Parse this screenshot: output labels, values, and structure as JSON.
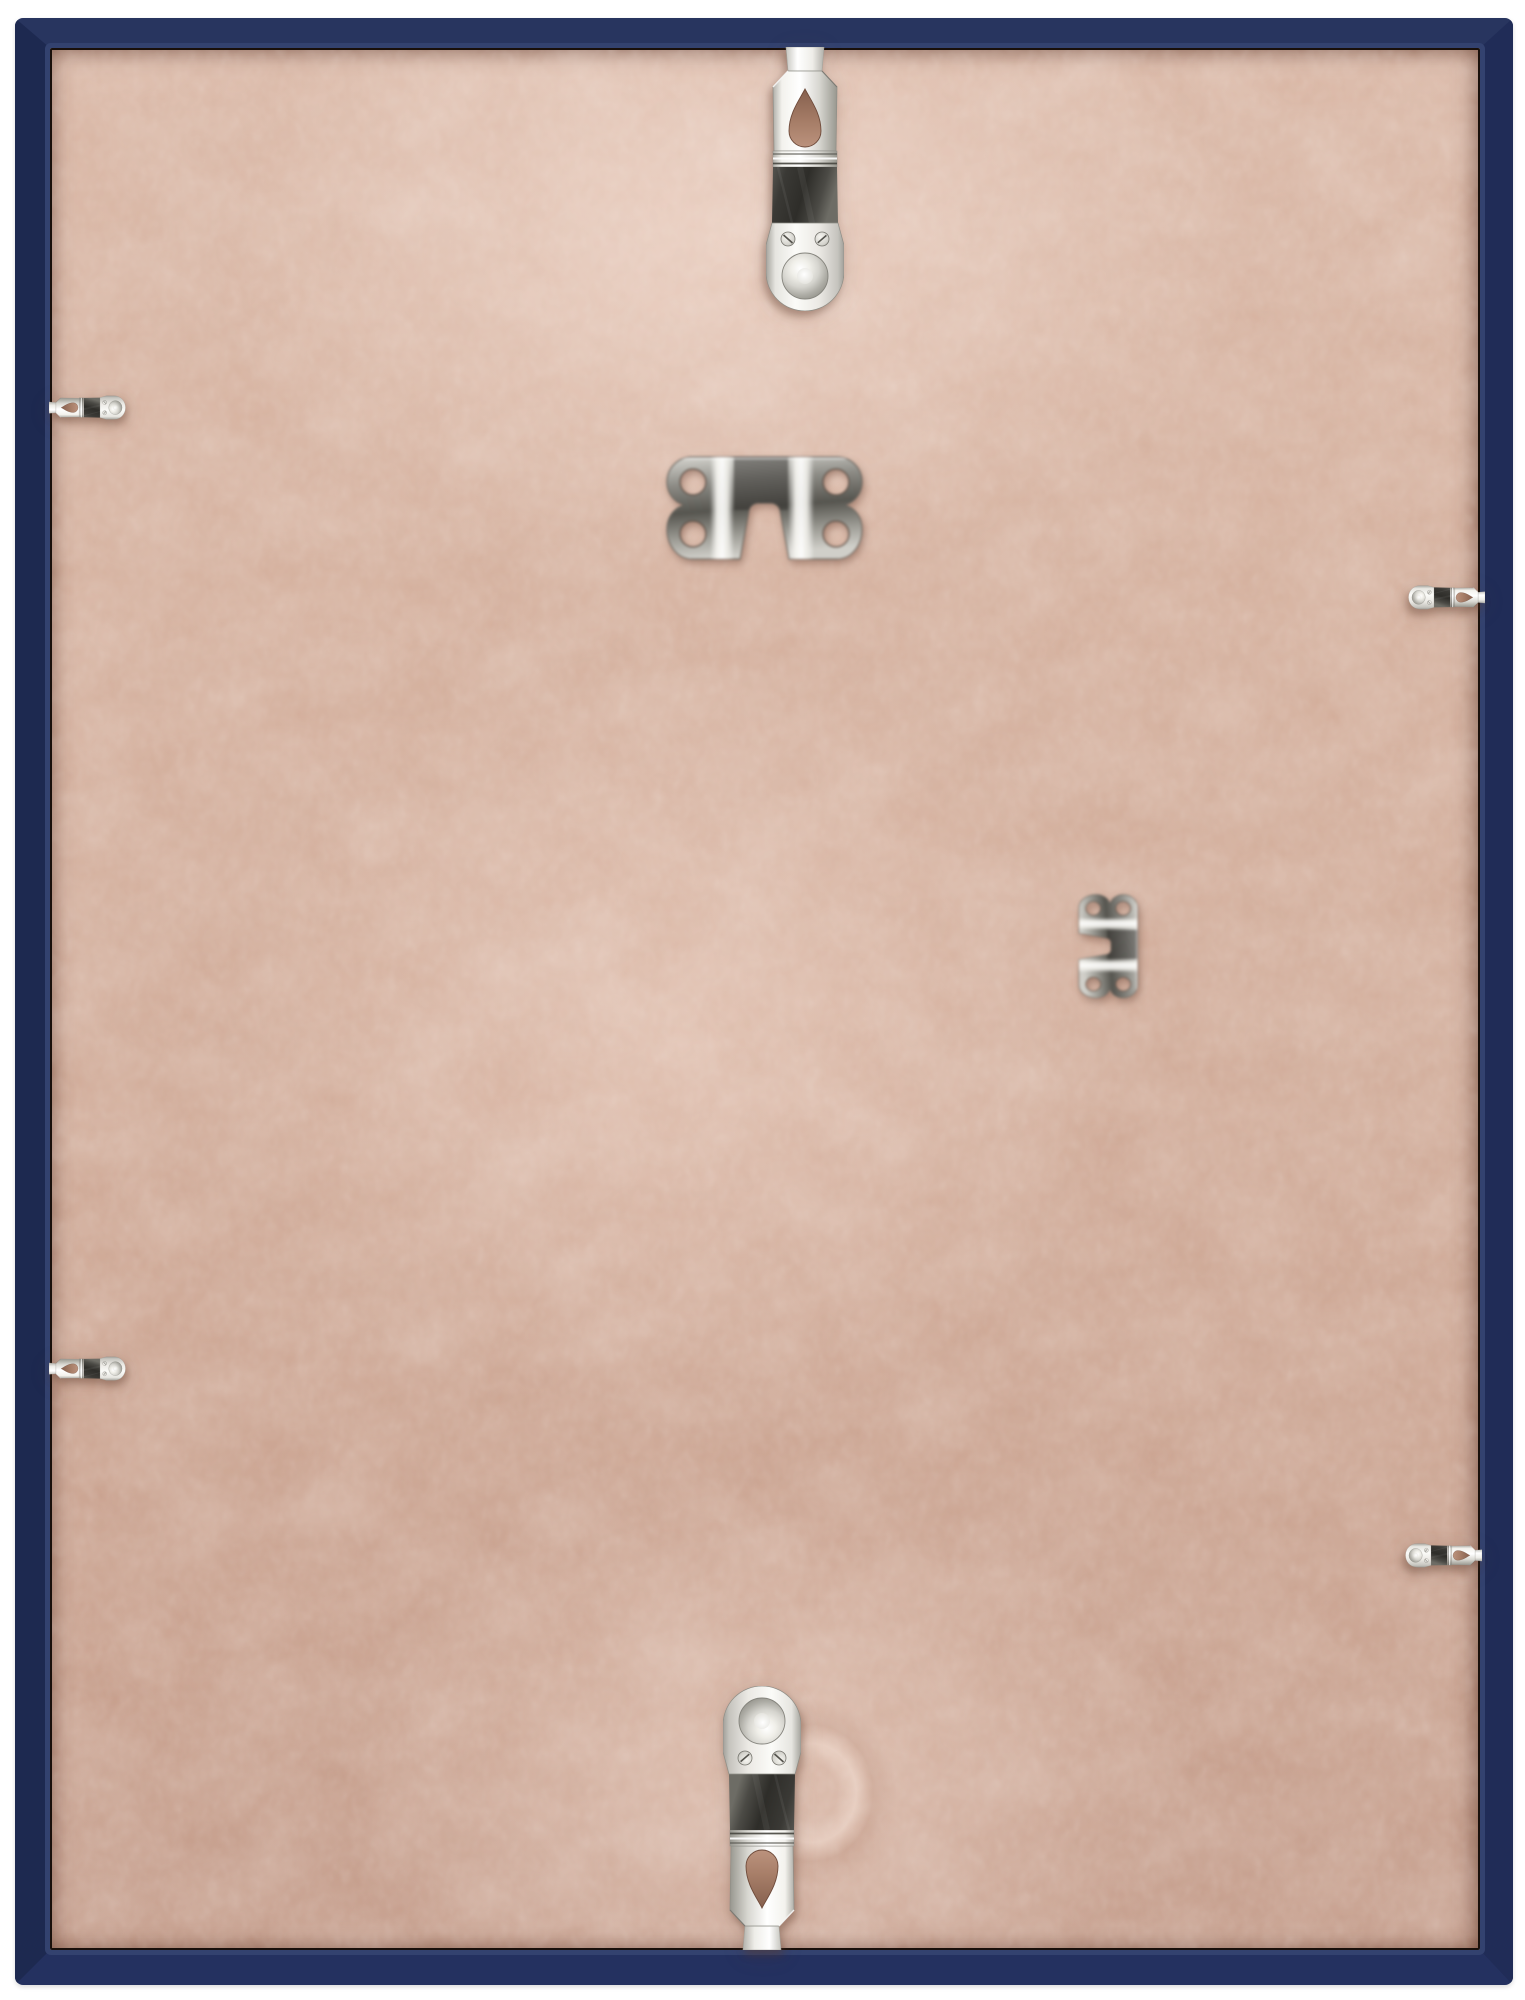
{
  "scene": {
    "subject": "Back view of a navy blue picture frame",
    "description": "Rear of a wall frame: tan MDF hardboard backing held in by six polished metal spring clips (one top center, two per side, one bottom center) plus two loose metal sawtooth-style hanger plates resting on the board (one upper center, one middle right)",
    "frame_color_name": "navy blue",
    "board_material": "MDF hardboard"
  },
  "hardware": {
    "spring_clips": {
      "count": 6,
      "finish": "polished silver metal, teardrop cutout, two screws and embossed dome on rounded pad",
      "items": [
        {
          "label": "spring clip - top center"
        },
        {
          "label": "spring clip - upper left"
        },
        {
          "label": "spring clip - upper right"
        },
        {
          "label": "spring clip - lower left"
        },
        {
          "label": "spring clip - lower right"
        },
        {
          "label": "spring clip - bottom center"
        }
      ]
    },
    "sawtooth_hangers": {
      "count": 2,
      "finish": "polished silver metal plate, four round holes, central notch",
      "items": [
        {
          "label": "sawtooth hanger - upper center, notch facing down"
        },
        {
          "label": "sawtooth hanger - middle right, notch facing left"
        }
      ]
    }
  },
  "palette": {
    "background": "#ffffff",
    "frame_top": "#28355f",
    "frame_right": "#202c57",
    "frame_bottom": "#243160",
    "frame_left": "#1d2950",
    "frame_inner_bevel": "#33426f",
    "frame_gap_shadow": "#19100b",
    "board_base": "#d0aa97",
    "board_light": "#ddbbaa",
    "board_shadow": "#a87f6d",
    "metal_bright": "#fbfbf8",
    "metal_mid": "#c9c8c2",
    "metal_dark": "#34332f",
    "hole_brown": "#a87f69"
  }
}
